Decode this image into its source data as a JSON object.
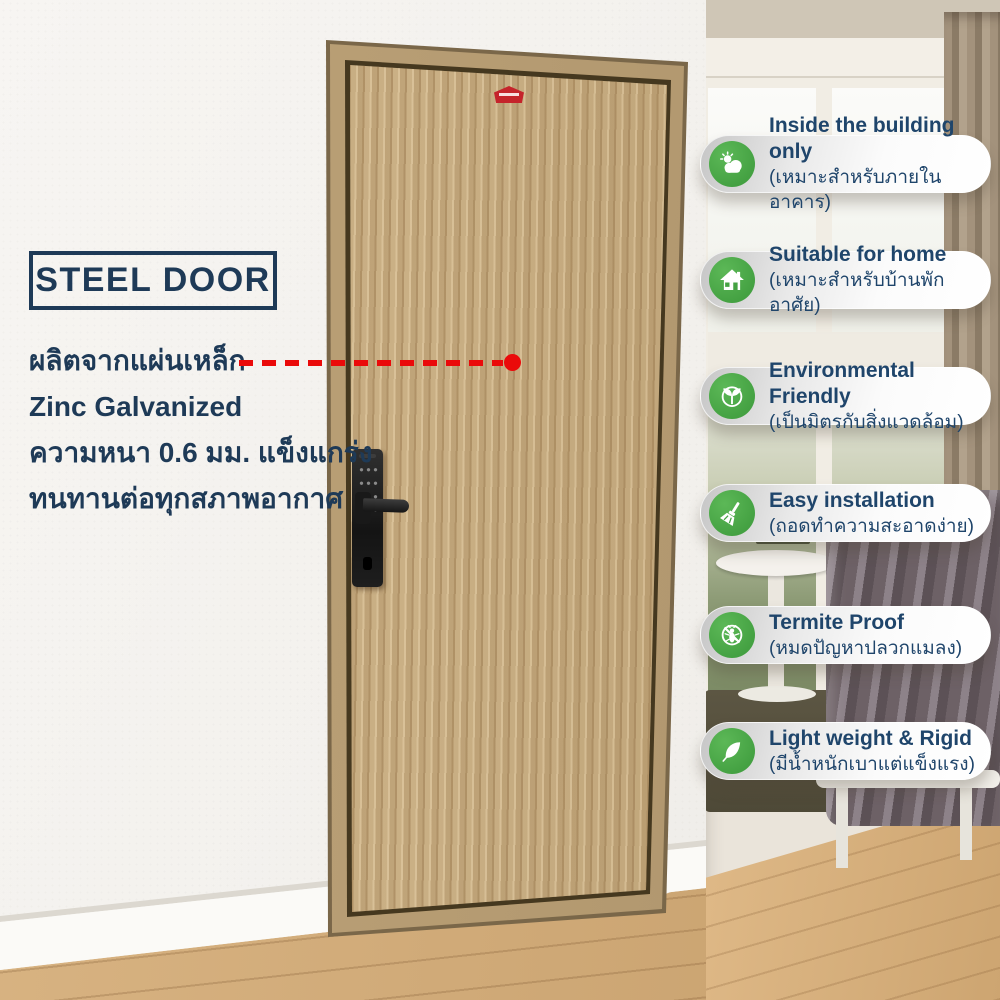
{
  "door_info": {
    "title": "STEEL DOOR",
    "lines": [
      "ผลิตจากแผ่นเหล็ก",
      "Zinc Galvanized",
      "ความหนา 0.6 มม. แข็งแกร่ง",
      "ทนทานต่อทุกสภาพอากาศ"
    ]
  },
  "features": [
    {
      "en": "Inside the building only",
      "th": "(เหมาะสำหรับภายในอาคาร)",
      "icon": "sun-cloud-icon"
    },
    {
      "en": "Suitable for home",
      "th": "(เหมาะสำหรับบ้านพักอาศัย)",
      "icon": "house-icon"
    },
    {
      "en": "Environmental Friendly",
      "th": "(เป็นมิตรกับสิ่งแวดล้อม)",
      "icon": "seedling-icon"
    },
    {
      "en": "Easy installation",
      "th": "(ถอดทำความสะอาดง่าย)",
      "icon": "broom-icon"
    },
    {
      "en": "Termite Proof",
      "th": "(หมดปัญหาปลวกแมลง)",
      "icon": "no-termite-icon"
    },
    {
      "en": "Light weight & Rigid",
      "th": "(มีน้ำหนักเบาแต่แข็งแรง)",
      "icon": "feather-icon"
    }
  ],
  "colors": {
    "text_navy": "#1e3a57",
    "icon_green": "#45a243",
    "pointer_red": "#ea0a0a",
    "brand_badge_red": "#c5242b"
  }
}
